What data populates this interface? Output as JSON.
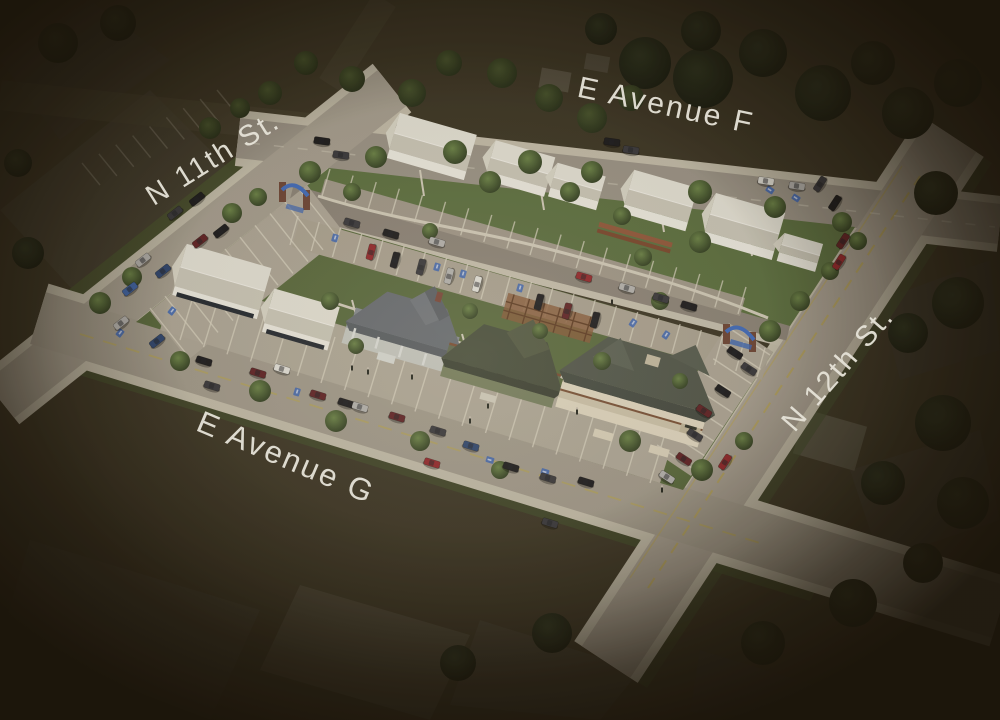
{
  "image": {
    "type": "aerial-3d-architectural-rendering",
    "description": "Bird's-eye rendering of a proposed block redevelopment highlighted by a spotlight, surrounded by darkened existing neighborhood"
  },
  "labels": {
    "avenue_f": "E Avenue F",
    "street_11": "N 11th St.",
    "street_12": "N 12th St.",
    "avenue_g": "E Avenue G"
  },
  "palette": {
    "label_text": "#e6e3d8",
    "road": "#a39c8e",
    "inner_road": "#8d857a",
    "sidewalk": "#c9c3b2",
    "lawn": "#5a6e3e",
    "white_massing": "#eae8dd",
    "accent_blue": "#3a65b8",
    "accent_yellow": "#b9a654",
    "brick": "#6e4434",
    "arbor_wood": "#8a5a38",
    "vignette": "#151008"
  },
  "scene": {
    "car_colors": [
      "#17171b",
      "#36363c",
      "#b7b6b4",
      "#e8e7e1",
      "#5f1e23",
      "#95242a",
      "#2a4472",
      "#3a62a8"
    ],
    "cars": [
      [
        175,
        213,
        -38,
        1
      ],
      [
        197,
        199,
        -38,
        0
      ],
      [
        200,
        241,
        -38,
        4
      ],
      [
        221,
        231,
        -38,
        0
      ],
      [
        143,
        260,
        -38,
        2
      ],
      [
        163,
        271,
        -38,
        6
      ],
      [
        130,
        289,
        -38,
        7
      ],
      [
        121,
        323,
        -38,
        2
      ],
      [
        157,
        341,
        -38,
        6
      ],
      [
        204,
        361,
        17,
        0
      ],
      [
        212,
        386,
        17,
        1
      ],
      [
        258,
        373,
        17,
        4
      ],
      [
        282,
        369,
        17,
        3
      ],
      [
        322,
        141,
        8,
        0
      ],
      [
        341,
        155,
        8,
        1
      ],
      [
        612,
        142,
        8,
        0
      ],
      [
        631,
        150,
        8,
        1
      ],
      [
        766,
        181,
        8,
        3
      ],
      [
        797,
        186,
        8,
        2
      ],
      [
        352,
        223,
        16,
        1
      ],
      [
        391,
        234,
        16,
        0
      ],
      [
        437,
        242,
        16,
        2
      ],
      [
        584,
        277,
        16,
        5
      ],
      [
        627,
        288,
        16,
        2
      ],
      [
        661,
        298,
        16,
        1
      ],
      [
        689,
        306,
        16,
        0
      ],
      [
        371,
        252,
        -75,
        5
      ],
      [
        395,
        260,
        -75,
        0
      ],
      [
        421,
        267,
        -75,
        1
      ],
      [
        449,
        276,
        -75,
        2
      ],
      [
        477,
        284,
        -75,
        3
      ],
      [
        539,
        302,
        -75,
        0
      ],
      [
        567,
        311,
        -75,
        4
      ],
      [
        595,
        320,
        -75,
        0
      ],
      [
        735,
        353,
        33,
        0
      ],
      [
        749,
        369,
        33,
        1
      ],
      [
        723,
        391,
        33,
        0
      ],
      [
        704,
        411,
        33,
        4
      ],
      [
        695,
        435,
        33,
        1
      ],
      [
        684,
        459,
        33,
        4
      ],
      [
        667,
        477,
        33,
        2
      ],
      [
        725,
        462,
        -57,
        5
      ],
      [
        820,
        184,
        -57,
        1
      ],
      [
        835,
        203,
        -57,
        0
      ],
      [
        843,
        241,
        -57,
        4
      ],
      [
        839,
        262,
        -57,
        5
      ],
      [
        318,
        395,
        17,
        4
      ],
      [
        346,
        403,
        17,
        0
      ],
      [
        360,
        407,
        17,
        2
      ],
      [
        397,
        417,
        17,
        4
      ],
      [
        438,
        431,
        17,
        1
      ],
      [
        471,
        446,
        17,
        6
      ],
      [
        432,
        463,
        17,
        5
      ],
      [
        511,
        467,
        17,
        0
      ],
      [
        548,
        478,
        17,
        1
      ],
      [
        586,
        482,
        17,
        0
      ],
      [
        550,
        523,
        17,
        1
      ]
    ],
    "trees_lit": [
      [
        100,
        303,
        11
      ],
      [
        132,
        277,
        10
      ],
      [
        232,
        213,
        10
      ],
      [
        258,
        197,
        9
      ],
      [
        310,
        172,
        11
      ],
      [
        376,
        157,
        11
      ],
      [
        455,
        152,
        12
      ],
      [
        530,
        162,
        12
      ],
      [
        592,
        172,
        11
      ],
      [
        700,
        192,
        12
      ],
      [
        775,
        207,
        11
      ],
      [
        842,
        222,
        10
      ],
      [
        352,
        192,
        9
      ],
      [
        490,
        182,
        11
      ],
      [
        570,
        192,
        10
      ],
      [
        622,
        216,
        9
      ],
      [
        700,
        242,
        11
      ],
      [
        643,
        257,
        9
      ],
      [
        430,
        231,
        8
      ],
      [
        660,
        301,
        9
      ],
      [
        330,
        301,
        9
      ],
      [
        356,
        346,
        8
      ],
      [
        470,
        311,
        8
      ],
      [
        540,
        331,
        8
      ],
      [
        602,
        361,
        9
      ],
      [
        680,
        381,
        8
      ],
      [
        702,
        470,
        11
      ],
      [
        744,
        441,
        9
      ],
      [
        180,
        361,
        10
      ],
      [
        260,
        391,
        11
      ],
      [
        336,
        421,
        11
      ],
      [
        420,
        441,
        10
      ],
      [
        500,
        470,
        9
      ],
      [
        630,
        441,
        11
      ],
      [
        770,
        331,
        11
      ],
      [
        800,
        301,
        10
      ],
      [
        830,
        271,
        9
      ],
      [
        858,
        241,
        9
      ]
    ],
    "trees_mid": [
      [
        270,
        93,
        12
      ],
      [
        306,
        63,
        12
      ],
      [
        352,
        79,
        13
      ],
      [
        412,
        93,
        14
      ],
      [
        449,
        63,
        13
      ],
      [
        502,
        73,
        15
      ],
      [
        549,
        98,
        14
      ],
      [
        592,
        118,
        15
      ],
      [
        631,
        98,
        13
      ],
      [
        210,
        128,
        11
      ],
      [
        240,
        108,
        10
      ]
    ],
    "trees_dark": [
      [
        645,
        63,
        26
      ],
      [
        703,
        78,
        30
      ],
      [
        763,
        53,
        24
      ],
      [
        823,
        93,
        28
      ],
      [
        873,
        63,
        22
      ],
      [
        908,
        113,
        26
      ],
      [
        958,
        83,
        24
      ],
      [
        936,
        193,
        22
      ],
      [
        958,
        303,
        26
      ],
      [
        908,
        333,
        20
      ],
      [
        943,
        423,
        28
      ],
      [
        883,
        483,
        22
      ],
      [
        963,
        503,
        26
      ],
      [
        853,
        603,
        24
      ],
      [
        923,
        563,
        20
      ],
      [
        763,
        643,
        22
      ],
      [
        28,
        253,
        16
      ],
      [
        18,
        163,
        14
      ],
      [
        58,
        43,
        20
      ],
      [
        118,
        23,
        18
      ],
      [
        701,
        31,
        20
      ],
      [
        601,
        29,
        16
      ],
      [
        552,
        633,
        20
      ],
      [
        458,
        663,
        18
      ]
    ],
    "handicap_marks": [
      [
        172,
        311,
        38
      ],
      [
        120,
        333,
        38
      ],
      [
        297,
        392,
        17
      ],
      [
        335,
        238,
        16
      ],
      [
        437,
        267,
        16
      ],
      [
        463,
        274,
        16
      ],
      [
        520,
        288,
        16
      ],
      [
        633,
        323,
        33
      ],
      [
        666,
        335,
        33
      ],
      [
        770,
        190,
        -57
      ],
      [
        796,
        198,
        -57
      ],
      [
        490,
        460,
        -73
      ],
      [
        545,
        472,
        -73
      ]
    ],
    "people": [
      [
        352,
        368
      ],
      [
        368,
        372
      ],
      [
        412,
        377
      ],
      [
        488,
        406
      ],
      [
        577,
        412
      ],
      [
        612,
        302
      ],
      [
        662,
        490
      ],
      [
        470,
        421
      ]
    ],
    "parking_rows": [
      {
        "a": [
          150,
          308
        ],
        "b": [
          300,
          190
        ],
        "d": [
          38,
          48
        ],
        "n": 10
      },
      {
        "a": [
          180,
          340
        ],
        "b": [
          650,
          483
        ],
        "d": [
          14,
          -46
        ],
        "n": 20
      },
      {
        "a": [
          298,
          216
        ],
        "b": [
          765,
          348
        ],
        "d": [
          -8,
          29
        ],
        "n": 22
      },
      {
        "a": [
          322,
          196
        ],
        "b": [
          738,
          314
        ],
        "d": [
          8,
          -27
        ],
        "n": 18
      },
      {
        "a": [
          695,
          470
        ],
        "b": [
          770,
          355
        ],
        "d": [
          -38,
          -25
        ],
        "n": 8
      },
      {
        "a": [
          100,
          185
        ],
        "b": [
          235,
          112
        ],
        "d": [
          -18,
          -22
        ],
        "n": 8,
        "o": 0.22
      }
    ],
    "massing_buildings": [
      [
        432,
        146,
        80,
        46,
        0
      ],
      [
        520,
        168,
        62,
        40,
        0
      ],
      [
        577,
        186,
        50,
        34,
        0
      ],
      [
        660,
        200,
        66,
        44,
        0
      ],
      [
        744,
        226,
        72,
        48,
        0
      ],
      [
        800,
        252,
        40,
        28,
        0
      ],
      [
        222,
        281,
        88,
        52,
        1
      ],
      [
        301,
        319,
        68,
        44,
        1
      ]
    ]
  }
}
